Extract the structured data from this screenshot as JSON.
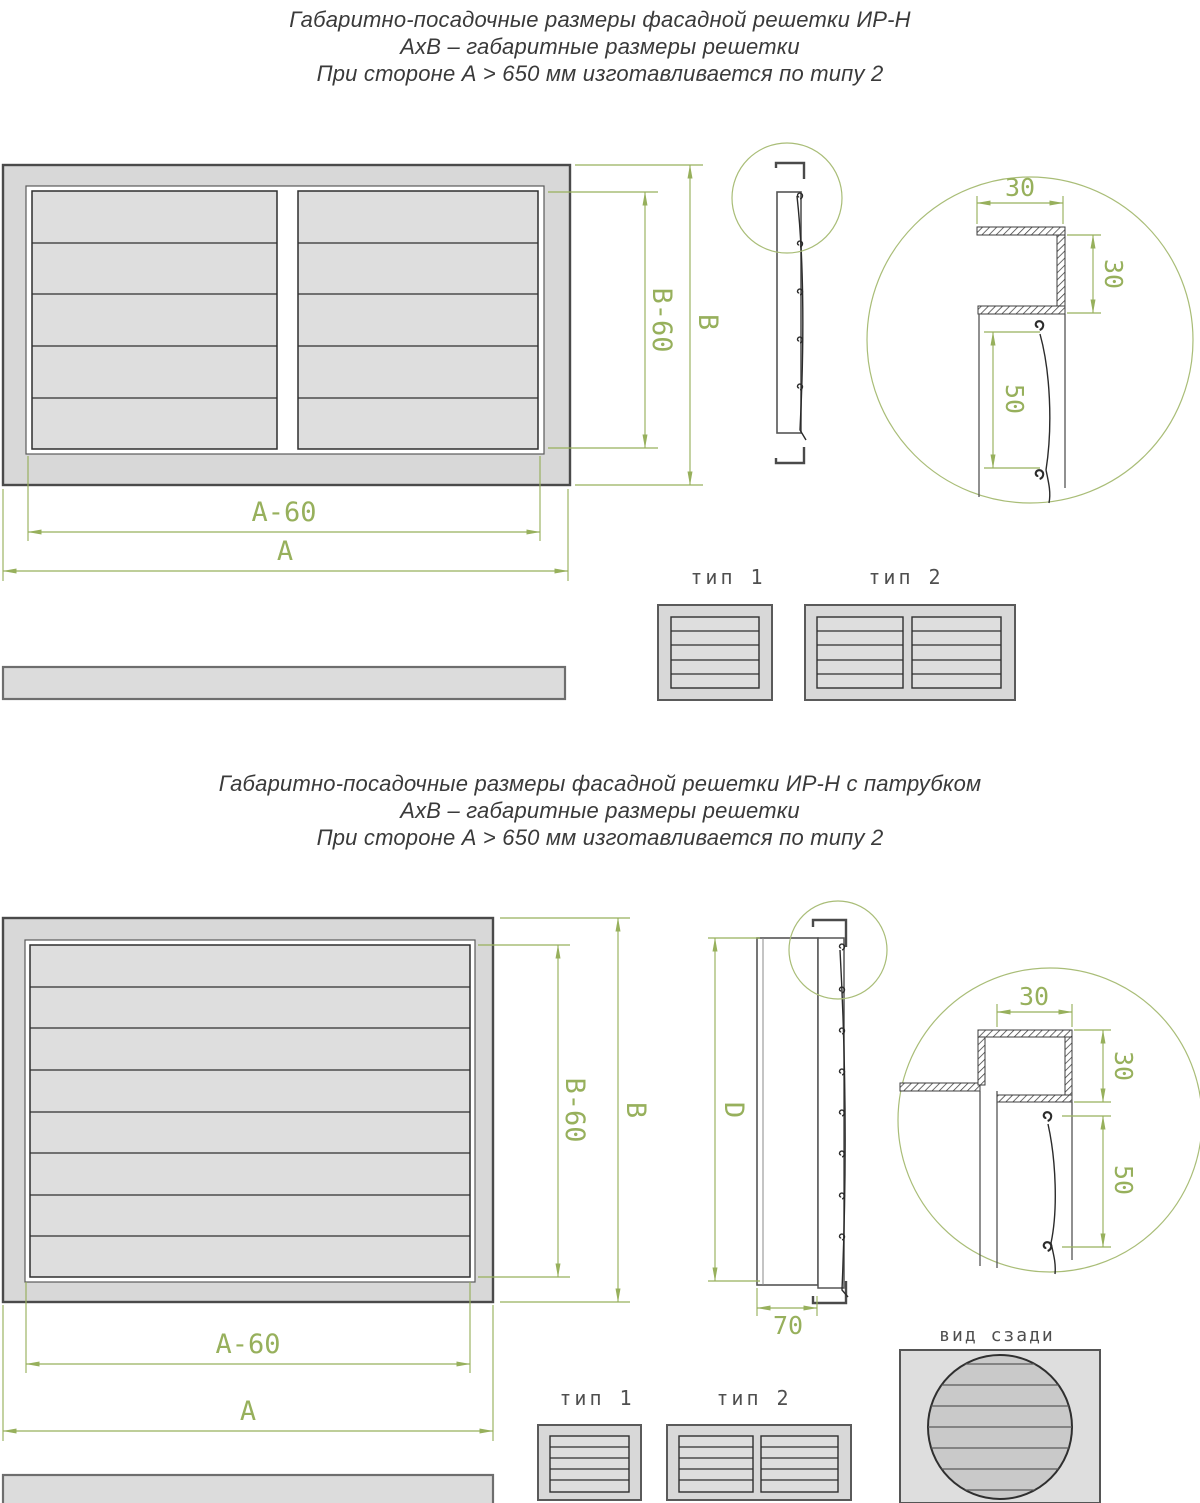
{
  "top_section": {
    "title_lines": [
      "Габаритно-посадочные размеры фасадной решетки ИР-Н",
      "АхВ – габаритные размеры решетки",
      "При стороне А > 650 мм изготавливается по типу 2"
    ],
    "dim_a": "A",
    "dim_a60": "A-60",
    "dim_b": "B",
    "dim_b60": "B-60",
    "detail": {
      "d30_top": "30",
      "d30_right": "30",
      "d50": "50"
    },
    "type1": "тип 1",
    "type2": "тип 2"
  },
  "bottom_section": {
    "title_lines": [
      "Габаритно-посадочные размеры фасадной решетки ИР-Н с патрубком",
      "АхВ – габаритные размеры решетки",
      "При стороне А > 650 мм изготавливается по типу 2"
    ],
    "dim_a": "A",
    "dim_a60": "A-60",
    "dim_b": "B",
    "dim_b60": "B-60",
    "dim_d": "D",
    "dim_70": "70",
    "detail": {
      "d30_top": "30",
      "d30_right": "30",
      "d50": "50"
    },
    "type1": "тип 1",
    "type2": "тип 2",
    "rear_label": "вид сзади"
  },
  "colors": {
    "dimension_green": "#97b05c",
    "frame_gray": "#d8d8d8",
    "slat_gray": "#dedede",
    "line_dark": "#4a4a4a"
  }
}
